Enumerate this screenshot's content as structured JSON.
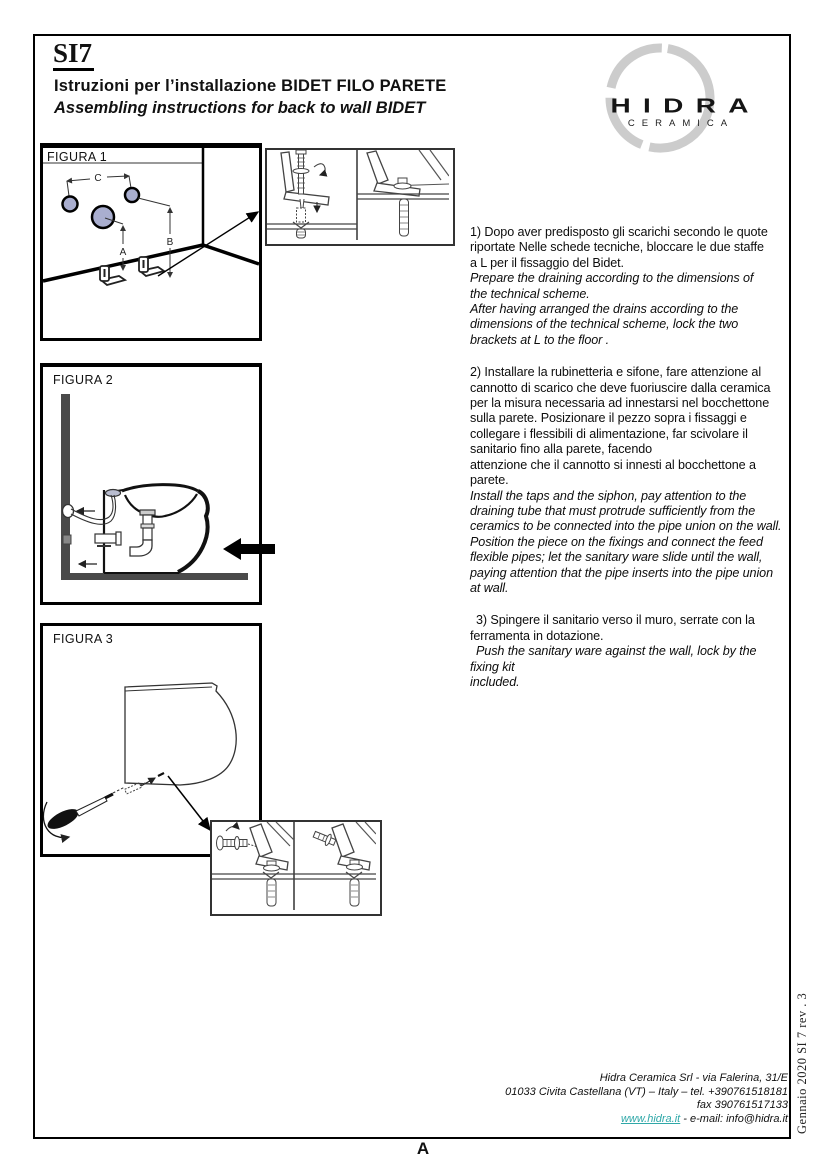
{
  "header": {
    "model": "SI7",
    "title_it": "Istruzioni per l’installazione BIDET  FILO PARETE",
    "title_en": "Assembling instructions for back to wall BIDET"
  },
  "logo": {
    "brand": "HIDRA",
    "subbrand": "CERAMICA"
  },
  "figures": {
    "fig1": {
      "label": "FIGURA 1",
      "dims": {
        "a": "A",
        "b": "B",
        "c": "C"
      }
    },
    "fig2": {
      "label": "FIGURA 2"
    },
    "fig3": {
      "label": "FIGURA 3"
    }
  },
  "steps": [
    {
      "it": "1) Dopo aver predisposto gli scarichi secondo le quote\nriportate Nelle schede tecniche, bloccare le due staffe\na L per il fissaggio del Bidet.",
      "en": "Prepare the draining according to the dimensions of\nthe technical scheme.\nAfter having arranged the drains according to the\ndimensions of the technical scheme, lock the two\nbrackets at L to the floor ."
    },
    {
      "it": "2) Installare la rubinetteria e sifone, fare attenzione al\ncannotto di scarico che deve fuoriuscire dalla ceramica\nper la misura necessaria ad innestarsi nel bocchettone\nsulla parete. Posizionare il pezzo sopra i fissaggi e\ncollegare i flessibili di alimentazione, far scivolare il\nsanitario fino alla parete, facendo\nattenzione che il cannotto si innesti al bocchettone a\nparete.",
      "en": "Install the taps and the siphon, pay attention to the\ndraining tube that must protrude sufficiently from the\nceramics to be connected into the pipe union on the wall.\nPosition the piece on the fixings and connect the feed\nflexible pipes; let the sanitary ware slide until the wall,\npaying attention that the pipe inserts into the pipe union\nat wall."
    },
    {
      "it": "3) Spingere il sanitario verso il muro, serrate con la\nferramenta in dotazione.",
      "en": "Push the sanitary ware against the wall, lock by the\nfixing kit\nincluded."
    }
  ],
  "footer": {
    "line1": "Hidra Ceramica Srl - via Falerina, 31/E",
    "line2": "01033 Civita Castellana (VT) – Italy – tel. +390761518181",
    "line3": "fax  390761517133",
    "website": "www.hidra.it",
    "email_suffix": " - e-mail: info@hidra.it"
  },
  "side_note": "Gennaio  2020  SI 7 rev . 3",
  "page_letter": "A",
  "colors": {
    "link": "#2fa8a8",
    "hole_fill": "#a9aecf",
    "wall_gray": "#4a4a4a",
    "logo_ring": "#cccccc"
  }
}
